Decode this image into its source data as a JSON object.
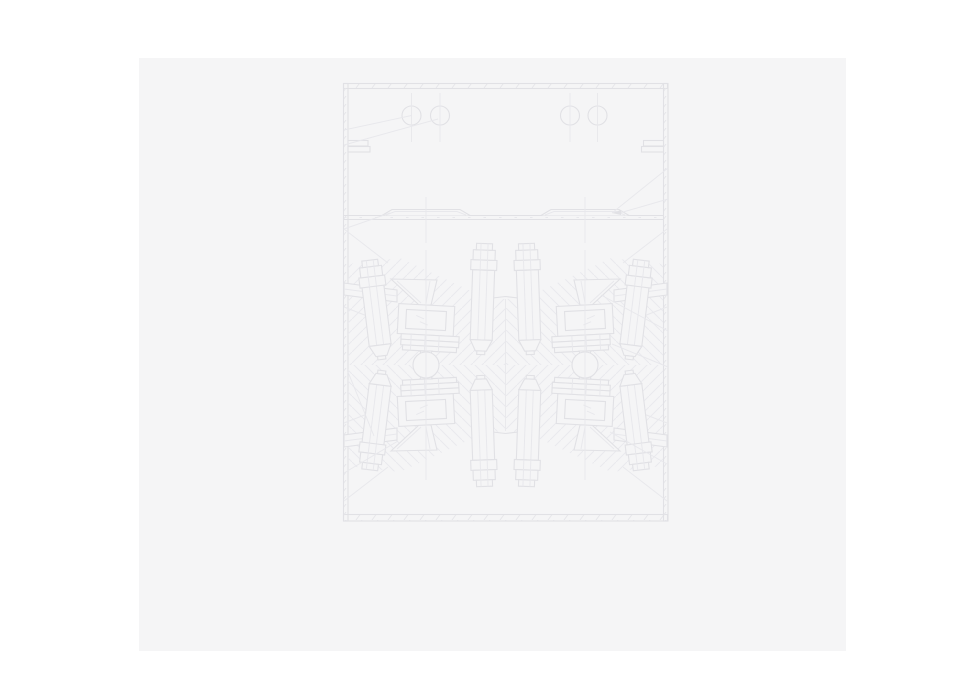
{
  "meta": {
    "description": "Faint gray engineering line drawing of a symmetric press/mold assembly on a light gray document page",
    "canvas_width": 961,
    "canvas_height": 694
  },
  "palette": {
    "canvas_bg": "#ffffff",
    "page_bg": "#f5f5f6",
    "line_main": "#e1e1e5",
    "line_faint": "#e8e8ec",
    "line_hatch": "#eaeaee"
  },
  "page": {
    "x": 139,
    "y": 58,
    "w": 707,
    "h": 593
  },
  "drawing": {
    "layers": [
      {
        "name": "document-page",
        "shapes": [
          {
            "t": "rect",
            "x": 139,
            "y": 58,
            "w": 707,
            "h": 593,
            "fill": "page",
            "stroke": "none"
          }
        ]
      },
      {
        "name": "frame-walls",
        "shapes": [
          {
            "t": "rect",
            "x": 343.5,
            "y": 83.5,
            "w": 324,
            "h": 5,
            "fill": "ticks",
            "name": "frame-top-band"
          },
          {
            "t": "rect",
            "x": 343.5,
            "y": 514.5,
            "w": 324,
            "h": 6.5,
            "fill": "ticks",
            "name": "frame-bottom-band"
          },
          {
            "t": "rect",
            "x": 343.5,
            "y": 83.5,
            "w": 4.5,
            "h": 437.5,
            "fill": "ticks",
            "name": "frame-left-wall"
          },
          {
            "t": "rect",
            "x": 663.5,
            "y": 83.5,
            "w": 4.5,
            "h": 437.5,
            "fill": "ticks",
            "name": "frame-right-wall"
          },
          {
            "t": "rect",
            "x": 348,
            "y": 140.5,
            "w": 20,
            "h": 5.5,
            "fill": "page",
            "name": "left-wall-flange-upper"
          },
          {
            "t": "rect",
            "x": 348,
            "y": 146.5,
            "w": 22,
            "h": 5.5,
            "fill": "page",
            "name": "left-wall-flange-lower"
          },
          {
            "t": "rect",
            "x": 643.5,
            "y": 140.5,
            "w": 20,
            "h": 5.5,
            "fill": "page",
            "name": "right-wall-flange-upper"
          },
          {
            "t": "rect",
            "x": 641.5,
            "y": 146.5,
            "w": 22,
            "h": 5.5,
            "fill": "page",
            "name": "right-wall-flange-lower"
          }
        ]
      },
      {
        "name": "upper-chamber",
        "shapes": [
          {
            "t": "circle",
            "cx": 411.5,
            "cy": 115.5,
            "r": 9.5,
            "name": "bolt-hole-circle"
          },
          {
            "t": "circle",
            "cx": 440,
            "cy": 115.5,
            "r": 9.5,
            "name": "bolt-hole-circle"
          },
          {
            "t": "circle",
            "cx": 570,
            "cy": 115.5,
            "r": 9.5,
            "name": "bolt-hole-circle"
          },
          {
            "t": "circle",
            "cx": 597.5,
            "cy": 115.5,
            "r": 9.5,
            "name": "bolt-hole-circle"
          },
          {
            "t": "line",
            "x1": 411.5,
            "y1": 93,
            "x2": 411.5,
            "y2": 142,
            "stroke": "faint"
          },
          {
            "t": "line",
            "x1": 440,
            "y1": 93,
            "x2": 440,
            "y2": 142,
            "stroke": "faint"
          },
          {
            "t": "line",
            "x1": 570,
            "y1": 93,
            "x2": 570,
            "y2": 142,
            "stroke": "faint"
          },
          {
            "t": "line",
            "x1": 597.5,
            "y1": 93,
            "x2": 597.5,
            "y2": 142,
            "stroke": "faint"
          },
          {
            "t": "line",
            "x1": 344,
            "y1": 130,
            "x2": 411.5,
            "y2": 115.5,
            "stroke": "faint",
            "name": "leader-line"
          },
          {
            "t": "line",
            "x1": 344,
            "y1": 145,
            "x2": 438,
            "y2": 119,
            "stroke": "faint",
            "name": "leader-line"
          }
        ]
      },
      {
        "name": "divider-and-rails",
        "shapes": [
          {
            "t": "line",
            "x1": 344,
            "y1": 215.5,
            "x2": 663.5,
            "y2": 215.5
          },
          {
            "t": "line",
            "x1": 344,
            "y1": 219.5,
            "x2": 663.5,
            "y2": 219.5
          },
          {
            "t": "line",
            "x1": 344,
            "y1": 217.5,
            "x2": 663.5,
            "y2": 217.5,
            "stroke": "faint",
            "dash": "2.5 13"
          },
          {
            "t": "path",
            "d": "M382,215.5 L392,209.5 L460,209.5 L470,215.5",
            "fill": "page",
            "name": "rail-profile-left"
          },
          {
            "t": "path",
            "d": "M386,215 L395,211.5 L457,211.5 L466,215",
            "stroke": "faint"
          },
          {
            "t": "path",
            "d": "M541,215.5 L551,209.5 L619,209.5 L629,215.5",
            "fill": "page",
            "name": "rail-profile-right"
          },
          {
            "t": "path",
            "d": "M545,215 L554,211.5 L616,211.5 L625,215",
            "stroke": "faint"
          },
          {
            "t": "line",
            "x1": 426,
            "y1": 197,
            "x2": 426,
            "y2": 243,
            "stroke": "faint"
          },
          {
            "t": "line",
            "x1": 585,
            "y1": 197,
            "x2": 585,
            "y2": 243,
            "stroke": "faint"
          },
          {
            "t": "line",
            "x1": 668,
            "y1": 168,
            "x2": 612,
            "y2": 213,
            "stroke": "faint",
            "name": "leader-line"
          },
          {
            "t": "line",
            "x1": 668,
            "y1": 199,
            "x2": 618,
            "y2": 213.5,
            "stroke": "faint",
            "name": "leader-line"
          },
          {
            "t": "poly",
            "pts": "612,213 621,210 621,215",
            "fill": "main",
            "stroke": "none",
            "name": "leader-arrowhead"
          },
          {
            "t": "line",
            "x1": 390,
            "y1": 213,
            "x2": 344,
            "y2": 229,
            "stroke": "faint",
            "name": "leader-line"
          }
        ]
      },
      {
        "name": "section-hatching",
        "shapes": [
          {
            "t": "poly",
            "pts": "348,264 400,258 484,297 505,299 505,365 348,365",
            "fill": "hatchA",
            "stroke": "none"
          },
          {
            "t": "poly",
            "pts": "663,264 611,258 527,297 506,299 506,365 663,365",
            "fill": "hatchB",
            "stroke": "none"
          },
          {
            "t": "poly",
            "pts": "348,466 400,472 484,433 505,431 505,365 348,365",
            "fill": "hatchB",
            "stroke": "none"
          },
          {
            "t": "poly",
            "pts": "663,466 611,472 527,433 506,431 506,365 663,365",
            "fill": "hatchA",
            "stroke": "none"
          }
        ]
      },
      {
        "name": "parting-lines",
        "shapes": [
          {
            "t": "path",
            "d": "M484,299 L505.5,296.5 L527,299"
          },
          {
            "t": "path",
            "d": "M484,431 L505.5,433.5 L527,431"
          },
          {
            "t": "line",
            "x1": 505.5,
            "y1": 299,
            "x2": 505.5,
            "y2": 431,
            "stroke": "faint"
          }
        ]
      }
    ],
    "unit": {
      "name": "press-unit",
      "instances": [
        {
          "name": "press-unit-top-left",
          "tr": ""
        },
        {
          "name": "press-unit-top-right",
          "tr": "translate(1011,0) scale(-1,1)"
        },
        {
          "name": "press-unit-bottom-left",
          "tr": "translate(0,730) scale(1,-1)"
        },
        {
          "name": "press-unit-bottom-right",
          "tr": "translate(1011,730) scale(-1,-1)"
        }
      ],
      "shapes": [
        {
          "t": "line",
          "x1": 344,
          "y1": 229,
          "x2": 388,
          "y2": 263,
          "stroke": "faint",
          "name": "leader-line"
        },
        {
          "t": "line",
          "x1": 344,
          "y1": 307,
          "x2": 380,
          "y2": 321,
          "stroke": "faint",
          "name": "leader-line"
        },
        {
          "t": "poly",
          "pts": "344,283 397,290 397,302 344,295",
          "fill": "page",
          "name": "yoke-bar"
        },
        {
          "t": "line",
          "x1": 344,
          "y1": 289,
          "x2": 397,
          "y2": 296,
          "stroke": "faint"
        },
        {
          "t": "poly",
          "pts": "391,279 437,280 431,305 419,305",
          "fill": "page",
          "name": "funnel"
        },
        {
          "t": "line",
          "x1": 397,
          "y1": 281,
          "x2": 421,
          "y2": 303,
          "stroke": "faint"
        },
        {
          "t": "line",
          "x1": 430,
          "y1": 281,
          "x2": 426,
          "y2": 303,
          "stroke": "faint"
        },
        {
          "t": "group",
          "tr": "rotate(3 426 320)",
          "name": "die-block",
          "shapes": [
            {
              "t": "rect",
              "x": 398,
              "y": 305,
              "w": 56,
              "h": 30,
              "fill": "page"
            },
            {
              "t": "rect",
              "x": 406,
              "y": 310.5,
              "w": 40,
              "h": 19
            },
            {
              "t": "line",
              "x1": 416,
              "y1": 316,
              "x2": 424,
              "y2": 319,
              "stroke": "faint"
            },
            {
              "t": "line",
              "x1": 420,
              "y1": 322,
              "x2": 428,
              "y2": 325,
              "stroke": "faint"
            },
            {
              "t": "rect",
              "x": 402,
              "y": 335,
              "w": 58,
              "h": 5.5,
              "fill": "page",
              "name": "plate"
            },
            {
              "t": "rect",
              "x": 402,
              "y": 340.5,
              "w": 58,
              "h": 5.5,
              "fill": "page",
              "name": "plate"
            },
            {
              "t": "rect",
              "x": 404,
              "y": 346,
              "w": 54,
              "h": 5,
              "fill": "page",
              "name": "plate"
            },
            {
              "t": "line",
              "x1": 412,
              "y1": 335,
              "x2": 412,
              "y2": 351,
              "stroke": "faint"
            },
            {
              "t": "line",
              "x1": 426,
              "y1": 335,
              "x2": 426,
              "y2": 351,
              "stroke": "faint"
            },
            {
              "t": "line",
              "x1": 440,
              "y1": 335,
              "x2": 440,
              "y2": 351,
              "stroke": "faint"
            }
          ]
        },
        {
          "t": "poly",
          "pts": "420,351 432,351 429,359 423,359",
          "fill": "page",
          "name": "stem"
        },
        {
          "t": "group",
          "tr": "rotate(-7 381 352)",
          "name": "outer-bolt",
          "shapes": [
            {
              "t": "rect",
              "x": 370,
              "y": 273,
              "w": 22,
              "h": 72,
              "fill": "page",
              "name": "bolt-shaft"
            },
            {
              "t": "line",
              "x1": 377.5,
              "y1": 273,
              "x2": 377.5,
              "y2": 345,
              "stroke": "faint"
            },
            {
              "t": "line",
              "x1": 384.5,
              "y1": 273,
              "x2": 384.5,
              "y2": 345,
              "stroke": "faint"
            },
            {
              "t": "poly",
              "pts": "370,345 392,345 386.5,356 375.5,356",
              "fill": "page",
              "name": "bolt-tip"
            },
            {
              "t": "rect",
              "x": 377,
              "y": 356,
              "w": 8,
              "h": 3.5,
              "fill": "page"
            },
            {
              "t": "rect",
              "x": 368,
              "y": 276,
              "w": 26,
              "h": 10,
              "fill": "page",
              "name": "bolt-head"
            },
            {
              "t": "rect",
              "x": 370,
              "y": 266,
              "w": 22,
              "h": 10,
              "fill": "page",
              "name": "bolt-head"
            },
            {
              "t": "rect",
              "x": 373,
              "y": 259.5,
              "w": 16,
              "h": 6.5,
              "fill": "page",
              "name": "bolt-head"
            },
            {
              "t": "line",
              "x1": 377.5,
              "y1": 259.5,
              "x2": 377.5,
              "y2": 286,
              "stroke": "faint"
            },
            {
              "t": "line",
              "x1": 384.5,
              "y1": 259.5,
              "x2": 384.5,
              "y2": 286,
              "stroke": "faint"
            }
          ]
        },
        {
          "t": "group",
          "tr": "rotate(2 481 346)",
          "name": "inner-bolt",
          "shapes": [
            {
              "t": "rect",
              "x": 470,
              "y": 270,
              "w": 22,
              "h": 70,
              "fill": "page",
              "name": "bolt-shaft"
            },
            {
              "t": "line",
              "x1": 477.5,
              "y1": 270,
              "x2": 477.5,
              "y2": 340,
              "stroke": "faint"
            },
            {
              "t": "line",
              "x1": 484.5,
              "y1": 270,
              "x2": 484.5,
              "y2": 340,
              "stroke": "faint"
            },
            {
              "t": "poly",
              "pts": "470,340 492,340 486.5,351 475.5,351",
              "fill": "page",
              "name": "bolt-tip"
            },
            {
              "t": "rect",
              "x": 477,
              "y": 351,
              "w": 8,
              "h": 3.5,
              "fill": "page"
            },
            {
              "t": "rect",
              "x": 468,
              "y": 260,
              "w": 26,
              "h": 10,
              "fill": "page",
              "name": "bolt-head"
            },
            {
              "t": "rect",
              "x": 470,
              "y": 250,
              "w": 22,
              "h": 10,
              "fill": "page",
              "name": "bolt-head"
            },
            {
              "t": "rect",
              "x": 473,
              "y": 243.5,
              "w": 16,
              "h": 6.5,
              "fill": "page",
              "name": "bolt-head"
            },
            {
              "t": "line",
              "x1": 477.5,
              "y1": 243.5,
              "x2": 477.5,
              "y2": 270,
              "stroke": "faint"
            },
            {
              "t": "line",
              "x1": 484.5,
              "y1": 243.5,
              "x2": 484.5,
              "y2": 270,
              "stroke": "faint"
            }
          ]
        }
      ]
    },
    "overlays": [
      {
        "name": "balls-and-centerlines",
        "shapes": [
          {
            "t": "circle",
            "cx": 426,
            "cy": 365,
            "r": 13,
            "fill": "page",
            "name": "pivot-ball-left"
          },
          {
            "t": "circle",
            "cx": 585,
            "cy": 365,
            "r": 13,
            "fill": "page",
            "name": "pivot-ball-right"
          },
          {
            "t": "line",
            "x1": 426,
            "y1": 250,
            "x2": 426,
            "y2": 480,
            "stroke": "faint"
          },
          {
            "t": "line",
            "x1": 585,
            "y1": 250,
            "x2": 585,
            "y2": 480,
            "stroke": "faint"
          }
        ]
      },
      {
        "name": "extra-leaders",
        "shapes": [
          {
            "t": "line",
            "x1": 601,
            "y1": 295,
            "x2": 668,
            "y2": 331,
            "stroke": "faint"
          },
          {
            "t": "line",
            "x1": 612,
            "y1": 344,
            "x2": 668,
            "y2": 367,
            "stroke": "faint"
          },
          {
            "t": "line",
            "x1": 344,
            "y1": 473,
            "x2": 398,
            "y2": 441,
            "stroke": "faint"
          },
          {
            "t": "line",
            "x1": 348,
            "y1": 372,
            "x2": 374,
            "y2": 436,
            "stroke": "faint"
          },
          {
            "t": "line",
            "x1": 610,
            "y1": 432,
            "x2": 667,
            "y2": 464,
            "stroke": "faint"
          }
        ]
      }
    ]
  }
}
